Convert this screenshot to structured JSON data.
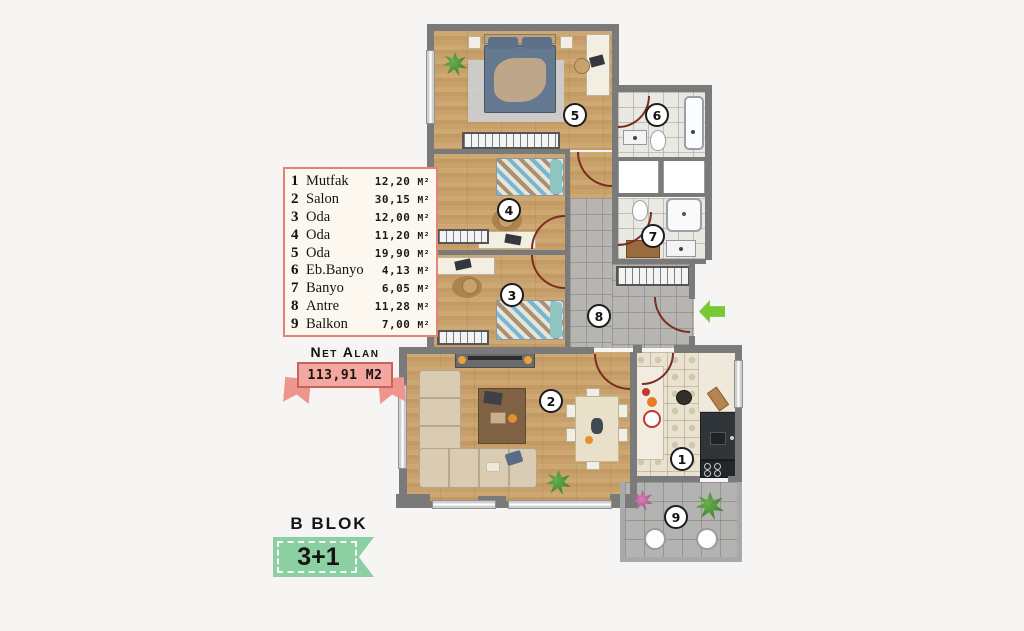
{
  "legend": {
    "unit": "M²",
    "items": [
      {
        "num": "1",
        "name": "Mutfak",
        "area": "12,20"
      },
      {
        "num": "2",
        "name": "Salon",
        "area": "30,15"
      },
      {
        "num": "3",
        "name": "Oda",
        "area": "12,00"
      },
      {
        "num": "4",
        "name": "Oda",
        "area": "11,20"
      },
      {
        "num": "5",
        "name": "Oda",
        "area": "19,90"
      },
      {
        "num": "6",
        "name": "Eb.Banyo",
        "area": "4,13"
      },
      {
        "num": "7",
        "name": "Banyo",
        "area": "6,05"
      },
      {
        "num": "8",
        "name": "Antre",
        "area": "11,28"
      },
      {
        "num": "9",
        "name": "Balkon",
        "area": "7,00"
      }
    ]
  },
  "net_area": {
    "label": "Net Alan",
    "value": "113,91 M2"
  },
  "block": {
    "name": "B BLOK",
    "plan_type": "3+1"
  },
  "plan": {
    "markers": [
      {
        "num": "1",
        "room": "Mutfak"
      },
      {
        "num": "2",
        "room": "Salon"
      },
      {
        "num": "3",
        "room": "Oda"
      },
      {
        "num": "4",
        "room": "Oda"
      },
      {
        "num": "5",
        "room": "Oda"
      },
      {
        "num": "6",
        "room": "Eb.Banyo"
      },
      {
        "num": "7",
        "room": "Banyo"
      },
      {
        "num": "8",
        "room": "Antre"
      },
      {
        "num": "9",
        "room": "Balkon"
      }
    ],
    "entrance_icon": "left-arrow"
  },
  "colors": {
    "legend_border": "#e2837a",
    "ribbon_pink": "#f4a7a0",
    "ribbon_green": "#8ccfa3",
    "arrow_green": "#79c937",
    "wall_gray": "#7a7a7a",
    "wood_floor": "#c7a06b",
    "tile_gray": "#b7b5b1",
    "background": "#f6f5f3"
  }
}
